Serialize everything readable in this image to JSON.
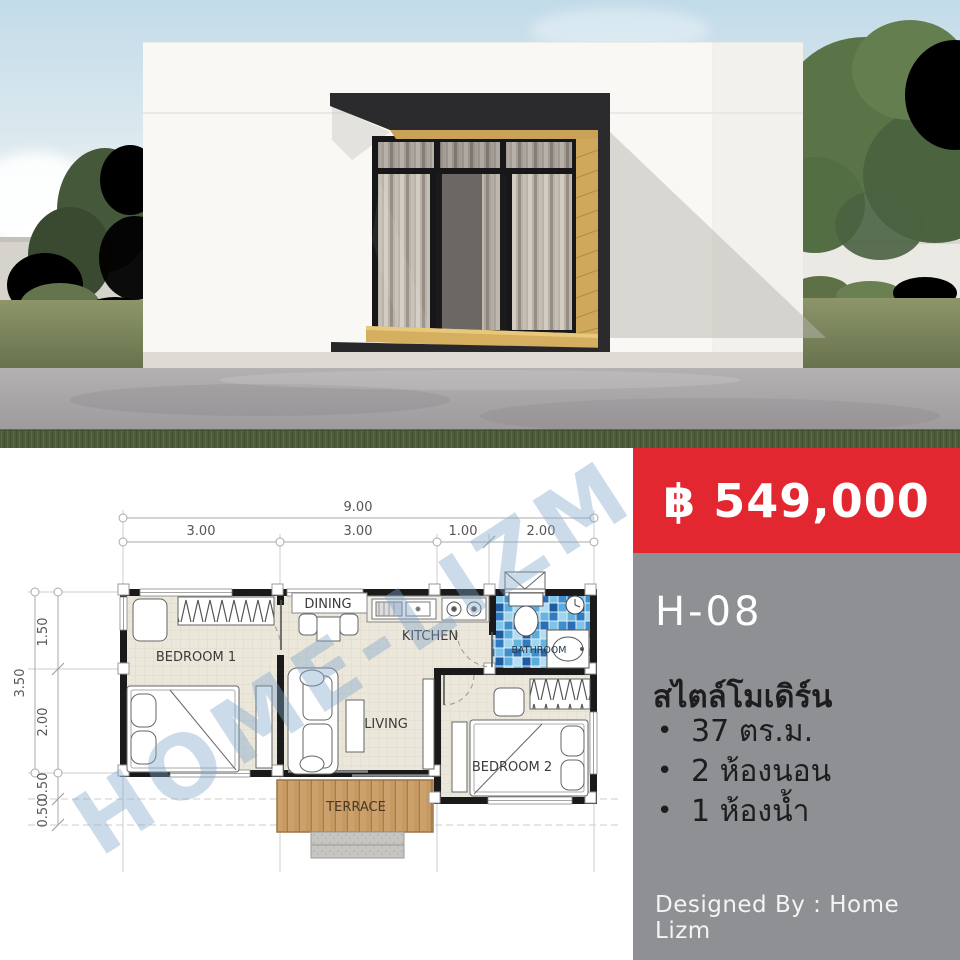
{
  "listing": {
    "price": "฿ 549,000",
    "model_code": "H-08",
    "style_title": "สไตล์โมเดิร์น",
    "specs": [
      {
        "bullet": "•",
        "text": "37 ตร.ม."
      },
      {
        "bullet": "•",
        "text": "2 ห้องนอน"
      },
      {
        "bullet": "•",
        "text": "1 ห้องน้ำ"
      }
    ],
    "footer": "Designed By : Home Lizm",
    "colors": {
      "price_bg": "#e22730",
      "panel_bg": "#8e9093",
      "price_text": "#ffffff"
    }
  },
  "floor_plan": {
    "watermark": "HOME-LIZM",
    "rooms": [
      "BEDROOM 1",
      "DINING",
      "KITCHEN",
      "BATHROOM",
      "LIVING",
      "BEDROOM 2",
      "TERRACE"
    ],
    "dimensions": {
      "top_total": "9.00",
      "top_segments": [
        "3.00",
        "3.00",
        "1.00",
        "2.00"
      ],
      "left_total": "3.50",
      "left_segments": [
        "1.50",
        "2.00",
        "0.50",
        "0.50"
      ]
    }
  }
}
